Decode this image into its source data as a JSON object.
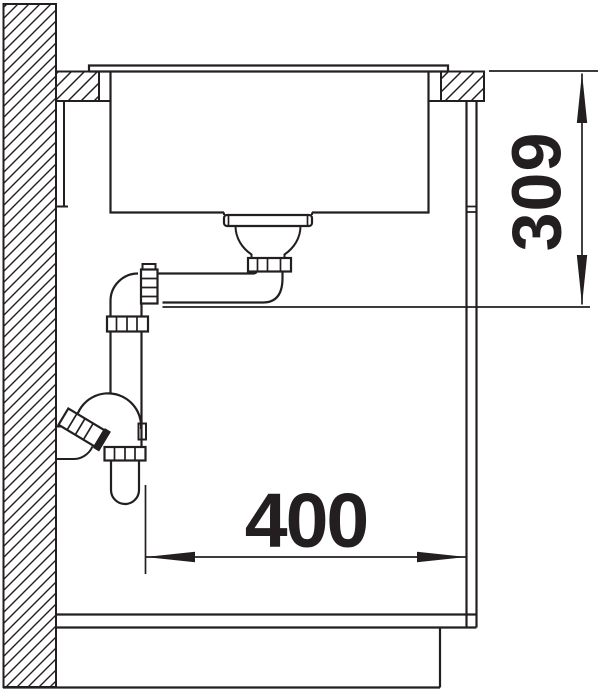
{
  "diagram": {
    "subject": "sink-cabinet-installation-section",
    "dimensions": {
      "height": {
        "value": "309",
        "orientation": "vertical"
      },
      "width": {
        "value": "400",
        "orientation": "horizontal"
      }
    }
  },
  "colors": {
    "line": "#231f20",
    "background": "#ffffff"
  }
}
